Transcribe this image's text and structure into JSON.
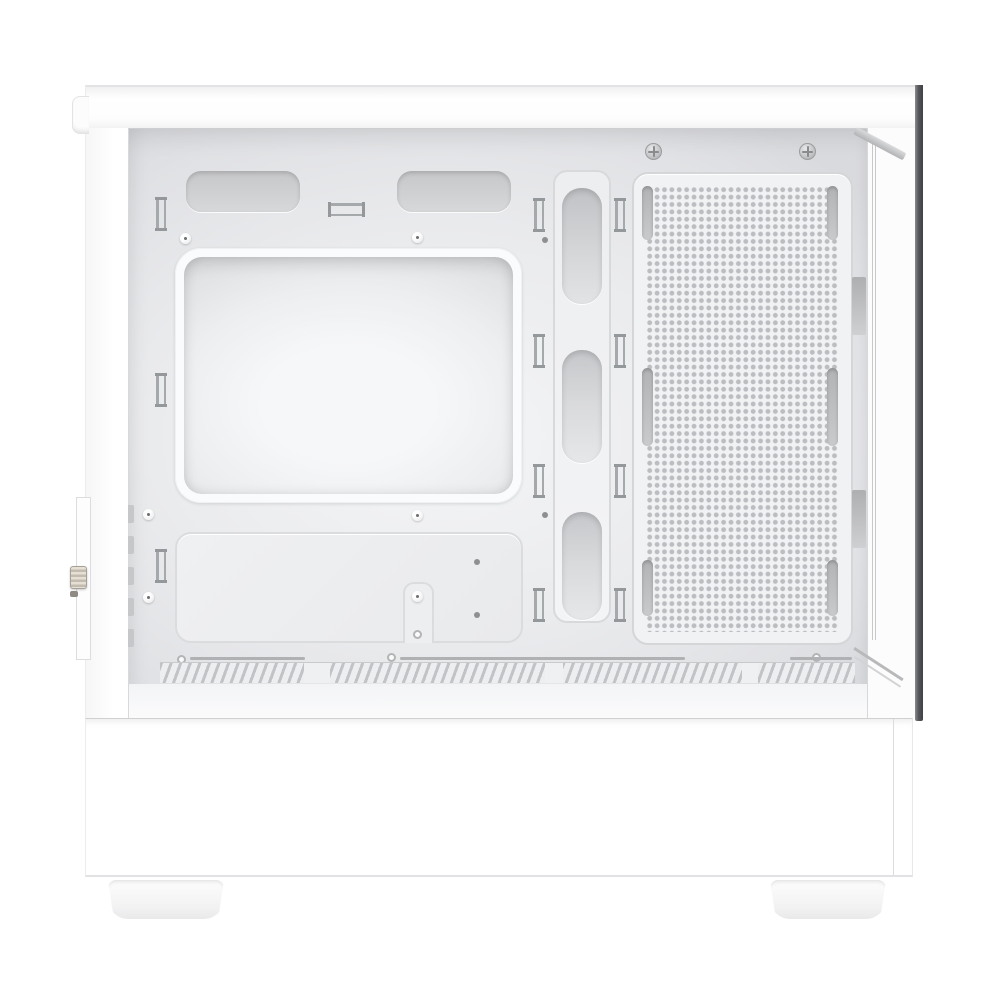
{
  "scene": {
    "description": "Product photo: side view of a white mid-tower PC case with the tempered-glass side panel removed, showing the empty internal chassis on a white background",
    "product": "white mid-tower PC case",
    "view": "left side, panel off",
    "visible_text": ""
  },
  "colors": {
    "background": "#ffffff",
    "case_exterior_white": "#fdfdfd",
    "interior_panel_light": "#f4f5f7",
    "interior_panel_shade": "#d9dadd",
    "cutout_fill": "#cfd0d3",
    "perforation_dot": "#bcbdc0",
    "hardware_gray": "#95989a",
    "glass_edge_dark": "#4a4b4d",
    "io_knob_beige": "#cdc6ba"
  },
  "parts": {
    "top_panel": "case top panel",
    "power_button_tab": "front-top power button tab",
    "top_vent_slots": [
      "top radiator vent slot left",
      "top radiator vent slot right"
    ],
    "motherboard_tray_cutout": "large CPU-cooler backplate cutout in motherboard tray",
    "cable_grommets": [
      "cable routing grommet top",
      "cable routing grommet middle",
      "cable routing grommet bottom"
    ],
    "fan_mount_panel": "perforated side fan / radiator mounting panel",
    "fan_rail_slots": "six elongated fan mounting slots",
    "panel_screws": [
      "rear panel screw left",
      "rear panel screw right"
    ],
    "cable_tie_points": "eleven cable-tie anchor loops",
    "psu_shroud_plate": "power-supply shroud side plate with cable notch",
    "front_intake_slots": "front intake vent dashes",
    "bottom_vent_hatch": "hatched bottom ventilation strip",
    "glass_panel_edge": "dark rear edge of removed tempered-glass panel",
    "front_io_module": "front I/O module seen edge-on with knurled knob",
    "case_feet": [
      "front foot",
      "rear foot"
    ]
  },
  "counts": {
    "top_vents": 2,
    "grommets": 3,
    "fan_slot_capsules": 6,
    "screws": 2,
    "tie_points": 11,
    "feet": 2
  }
}
